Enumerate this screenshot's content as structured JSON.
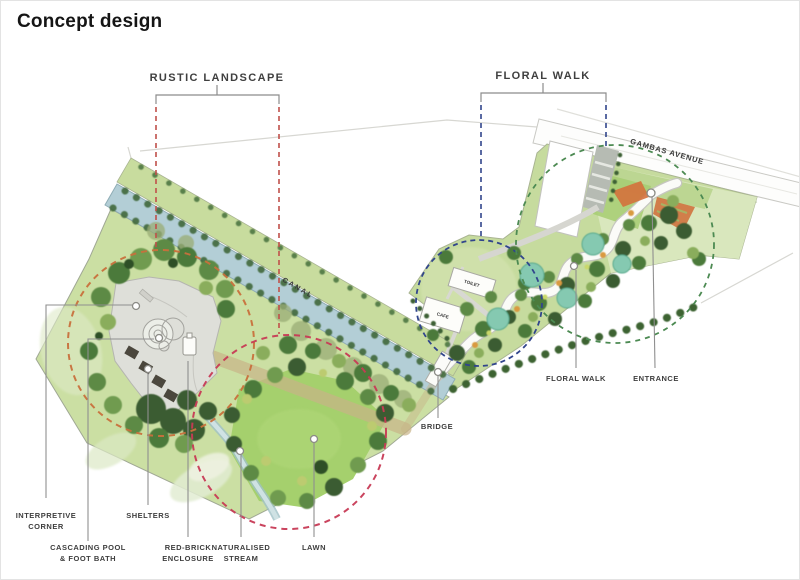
{
  "title": "Concept design",
  "zones": {
    "rustic": {
      "label": "RUSTIC LANDSCAPE",
      "dash_color": "#c0504a"
    },
    "floral": {
      "label": "FLORAL WALK",
      "dash_color": "#31458c"
    }
  },
  "map_labels": {
    "canal": "CANAL",
    "gambas_avenue": "GAMBAS AVENUE",
    "toilet": "TOILET",
    "cafe": "CAFE"
  },
  "callouts": {
    "interpretive_corner": {
      "line1": "INTERPRETIVE",
      "line2": "CORNER"
    },
    "cascading_pool": {
      "line1": "CASCADING POOL",
      "line2": "& FOOT BATH"
    },
    "shelters": {
      "line1": "SHELTERS"
    },
    "red_brick_enclosure": {
      "line1": "RED-BRICK",
      "line2": "ENCLOSURE"
    },
    "naturalised_stream": {
      "line1": "NATURALISED",
      "line2": "STREAM"
    },
    "lawn": {
      "line1": "LAWN"
    },
    "bridge": {
      "line1": "BRIDGE"
    },
    "floral_walk": {
      "line1": "FLORAL WALK"
    },
    "entrance": {
      "line1": "ENTRANCE"
    }
  },
  "feature_circles": {
    "interpretive_corner": "#c8703c",
    "lawn": "#c73a55",
    "cafe": "#31458c",
    "entrance": "#4c8a52"
  }
}
